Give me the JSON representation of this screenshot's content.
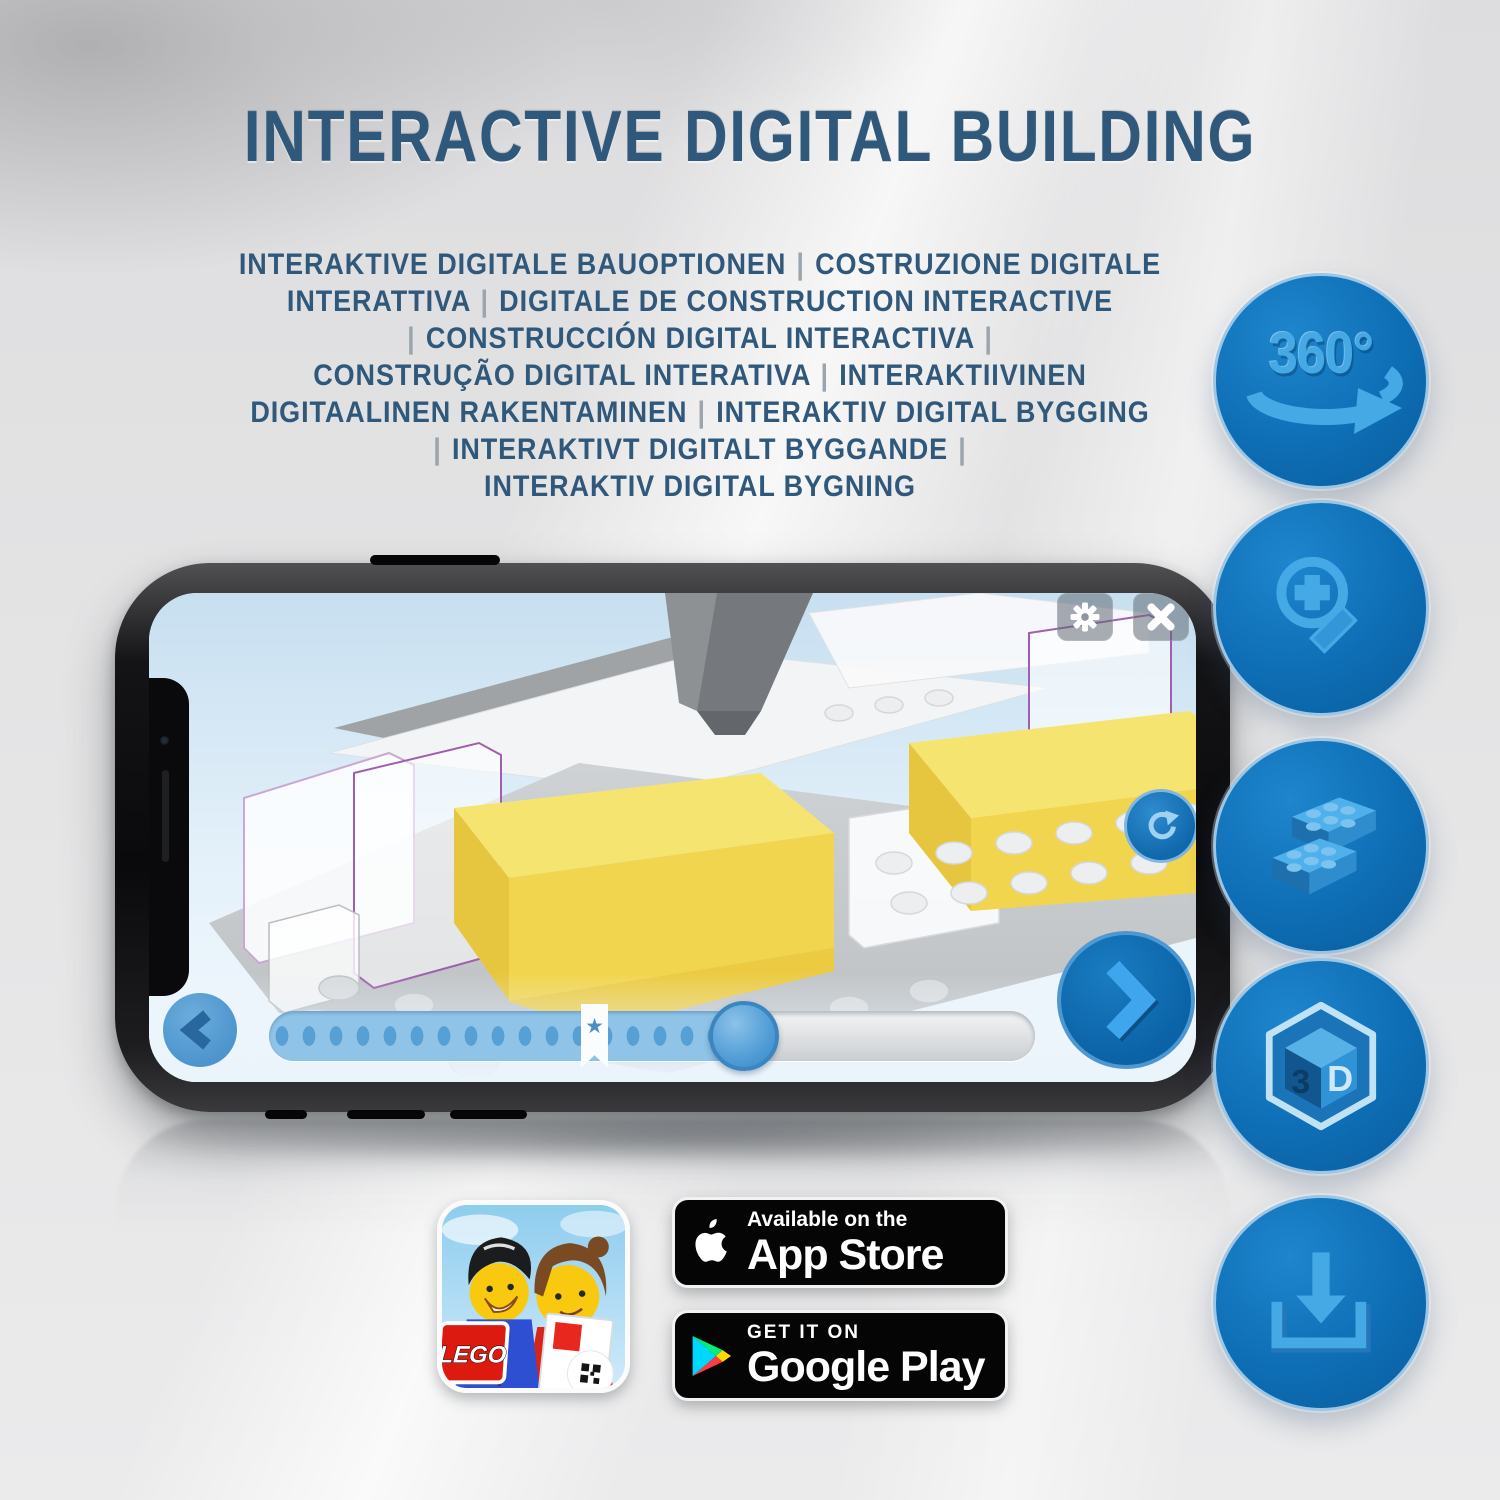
{
  "header": {
    "title": "INTERACTIVE DIGITAL BUILDING",
    "subtitle_lines": [
      "INTERAKTIVE DIGITALE BAUOPTIONEN | COSTRUZIONE DIGITALE",
      "INTERATTIVA | DIGITALE DE CONSTRUCTION INTERACTIVE",
      "| CONSTRUCCIÓN DIGITAL INTERACTIVA |",
      "CONSTRUÇÃO DIGITAL INTERATIVA | INTERAKTIIVINEN",
      "DIGITAALINEN RAKENTAMINEN | INTERAKTIV DIGITAL BYGGING",
      "| INTERAKTIVT DIGITALT BYGGANDE |",
      "INTERAKTIV DIGITAL BYGNING"
    ]
  },
  "features": {
    "items": [
      {
        "name": "360-rotation-icon",
        "label": "360°"
      },
      {
        "name": "zoom-in-icon"
      },
      {
        "name": "building-bricks-icon"
      },
      {
        "name": "3d-cube-icon",
        "face_left": "3",
        "face_right": "D"
      },
      {
        "name": "download-icon"
      }
    ]
  },
  "phone_app": {
    "bookmark_star": "★"
  },
  "store": {
    "app_store": {
      "tagline": "Available on the",
      "name": "App Store"
    },
    "google_play": {
      "tagline": "GET IT ON",
      "name": "Google Play"
    },
    "app_icon": {
      "logo": "LEGO"
    }
  },
  "colors": {
    "headline_blue": "#30587a",
    "circle_blue": "#0e6eb5",
    "icon_light_blue": "#41a4e6",
    "brick_yellow": "#f2d54e",
    "badge_black": "#050505"
  }
}
